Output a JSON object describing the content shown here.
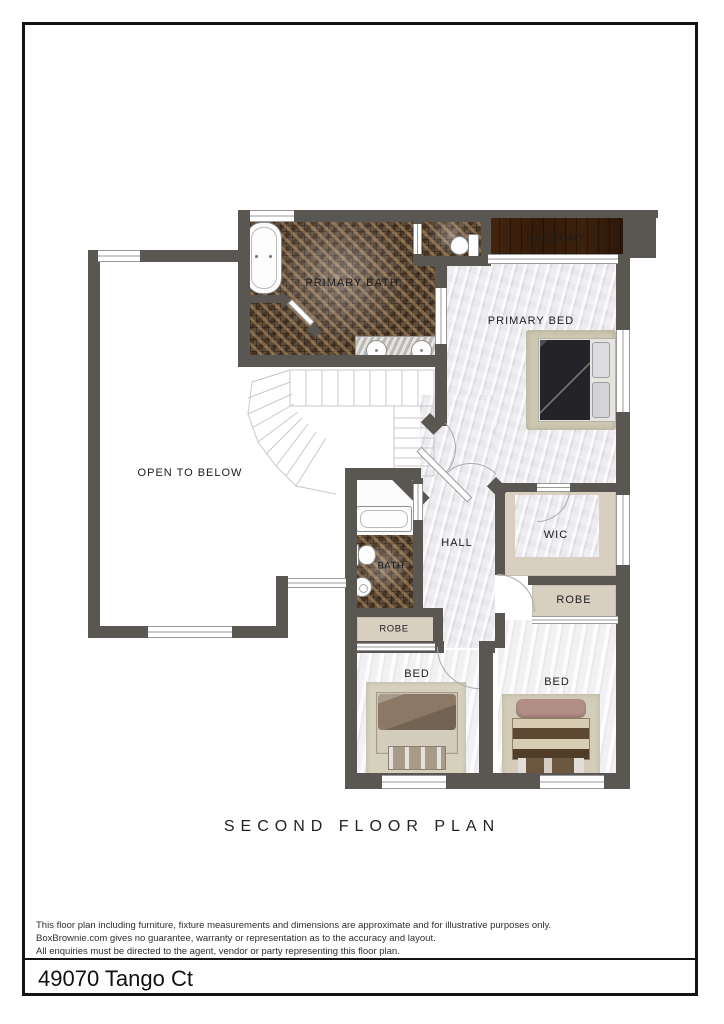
{
  "page": {
    "title": "SECOND FLOOR PLAN",
    "address": "49070 Tango Ct",
    "disclaimer": [
      "This floor plan including furniture, fixture measurements and dimensions are approximate and for illustrative purposes only.",
      "BoxBrownie.com gives no guarantee, warranty or representation as to the accuracy and layout.",
      "All enquiries must be directed to the agent, vendor or party representing this floor plan."
    ]
  },
  "rooms": {
    "primary_bath": {
      "label": "PRIMARY BATH"
    },
    "balcony": {
      "label": "BALCONY"
    },
    "primary_bed": {
      "label": "PRIMARY BED"
    },
    "open_to_below": {
      "label": "OPEN TO BELOW"
    },
    "hall": {
      "label": "HALL"
    },
    "wic": {
      "label": "WIC"
    },
    "bath": {
      "label": "BATH"
    },
    "robe_left": {
      "label": "ROBE"
    },
    "robe_right": {
      "label": "ROBE"
    },
    "bed_left": {
      "label": "BED"
    },
    "bed_right": {
      "label": "BED"
    }
  },
  "colors": {
    "wall": "#5a5753",
    "mosaic_tile": "#5f4c39",
    "balcony_wood": "#7a5a38",
    "marble_floor": "#e9e9ec",
    "joinery_beige": "#d9cfc0",
    "primary_bed_duvet": "#232328"
  }
}
